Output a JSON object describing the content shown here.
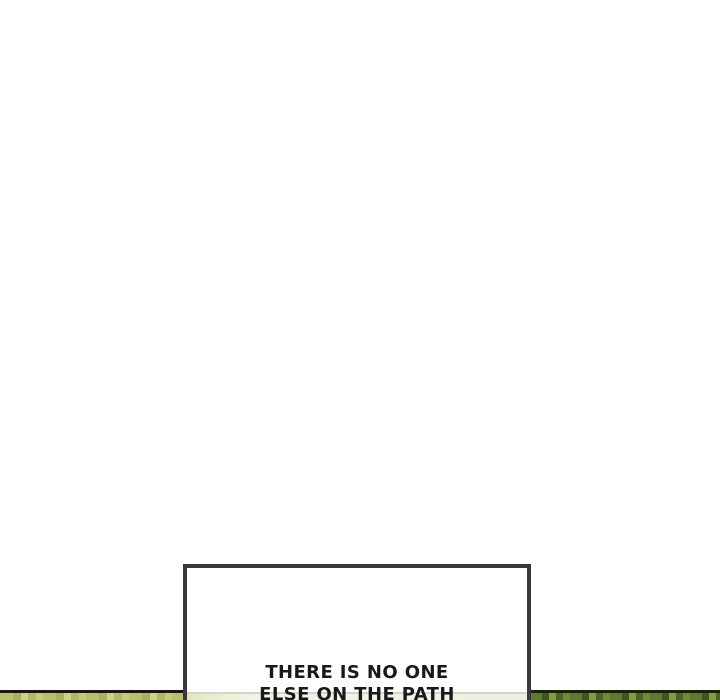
{
  "page": {
    "width_px": 720,
    "height_px": 700,
    "background_color": "#ffffff"
  },
  "caption_panel": {
    "border_color": "#39393d",
    "fill_color": "#ffffff",
    "dialogue": {
      "line1": "THERE IS NO ONE",
      "line2": "ELSE ON THE PATH",
      "text_color": "#191919"
    }
  },
  "bottom_panel": {
    "top_border_color": "#161616",
    "left_foliage_colors": [
      "#b9c06a",
      "#a8b25c",
      "#ccd385",
      "#c3ca78"
    ],
    "right_foliage_colors": [
      "#5d7a31",
      "#41561f",
      "#7fa040",
      "#6d8c36"
    ],
    "caption_haze_color": "#eef0df",
    "caption_haze_line_color": "#d8d3c9"
  }
}
